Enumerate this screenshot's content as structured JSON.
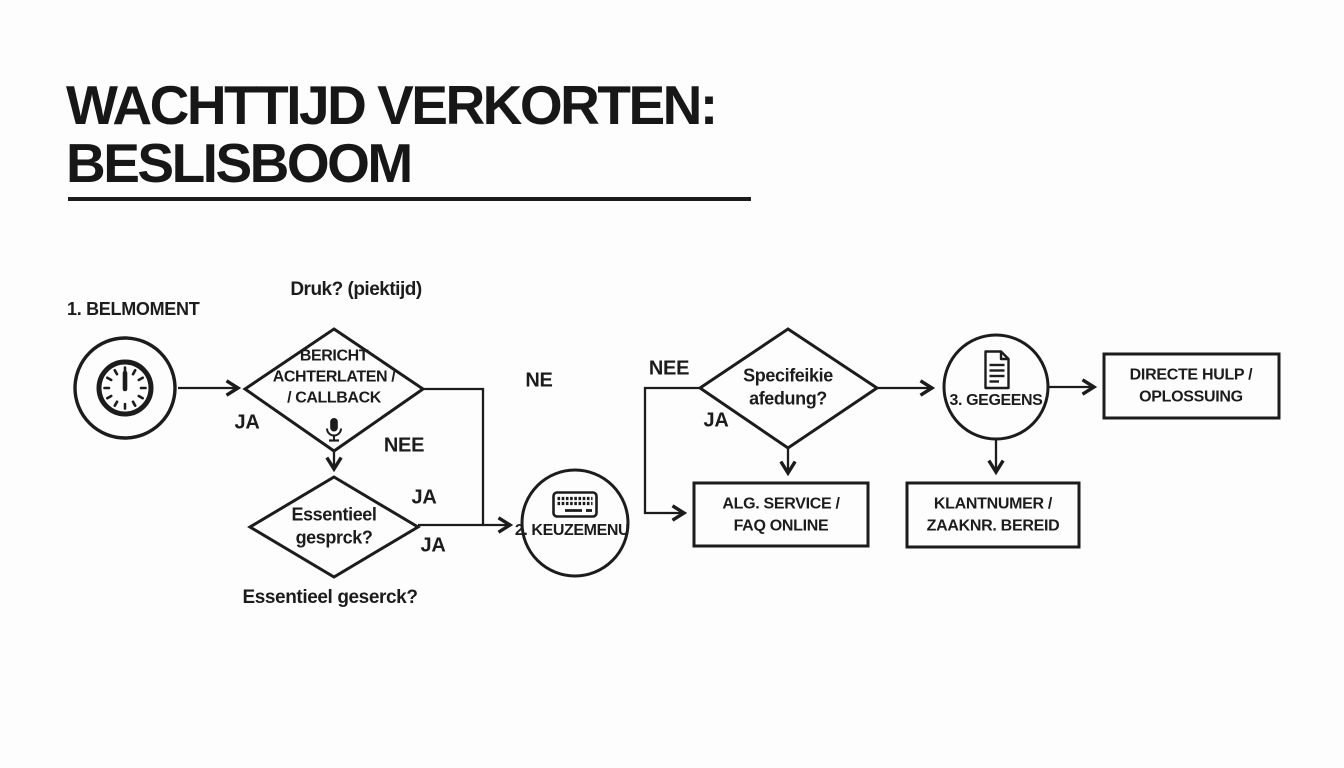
{
  "title": {
    "line1": "WACHTTIJD VERKORTEN:",
    "line2": "BESLISBOOM"
  },
  "colors": {
    "background": "#fdfdfd",
    "ink": "#1c1c1c"
  },
  "nodes": {
    "belmoment": {
      "label": "1. BELMOMENT",
      "icon": "clock-icon"
    },
    "keuzemenu": {
      "label": "2. KEUZEMENU",
      "icon": "keyboard-icon"
    },
    "gegevens": {
      "label": "3. GEGEENS",
      "icon": "document-icon"
    }
  },
  "decisions": {
    "d1": {
      "question_above": "Druk? (piektijd)",
      "line1": "BERICHT",
      "line2": "ACHTERLATEN /",
      "line3": "/ CALLBACK",
      "icon": "microphone-icon"
    },
    "d2": {
      "line1": "Essentieel",
      "line2": "gesprck?",
      "caption_below": "Essentieel geserck?"
    },
    "d3": {
      "line1": "Specifeikie",
      "line2": "afedung?"
    }
  },
  "outcomes": {
    "alg_service": {
      "line1": "ALG. SERVICE /",
      "line2": "FAQ ONLINE"
    },
    "klantnummer": {
      "line1": "KLANTNUMER /",
      "line2": "ZAAKNR. BEREID"
    },
    "directe_hulp": {
      "line1": "DIRECTE HULP /",
      "line2": "OPLOSSUING"
    }
  },
  "edge_labels": {
    "ja1": "JA",
    "nee1": "NEE",
    "ja2": "JA",
    "ja3": "JA",
    "ne": "NE",
    "nee2": "NEE",
    "ja4": "JA"
  }
}
